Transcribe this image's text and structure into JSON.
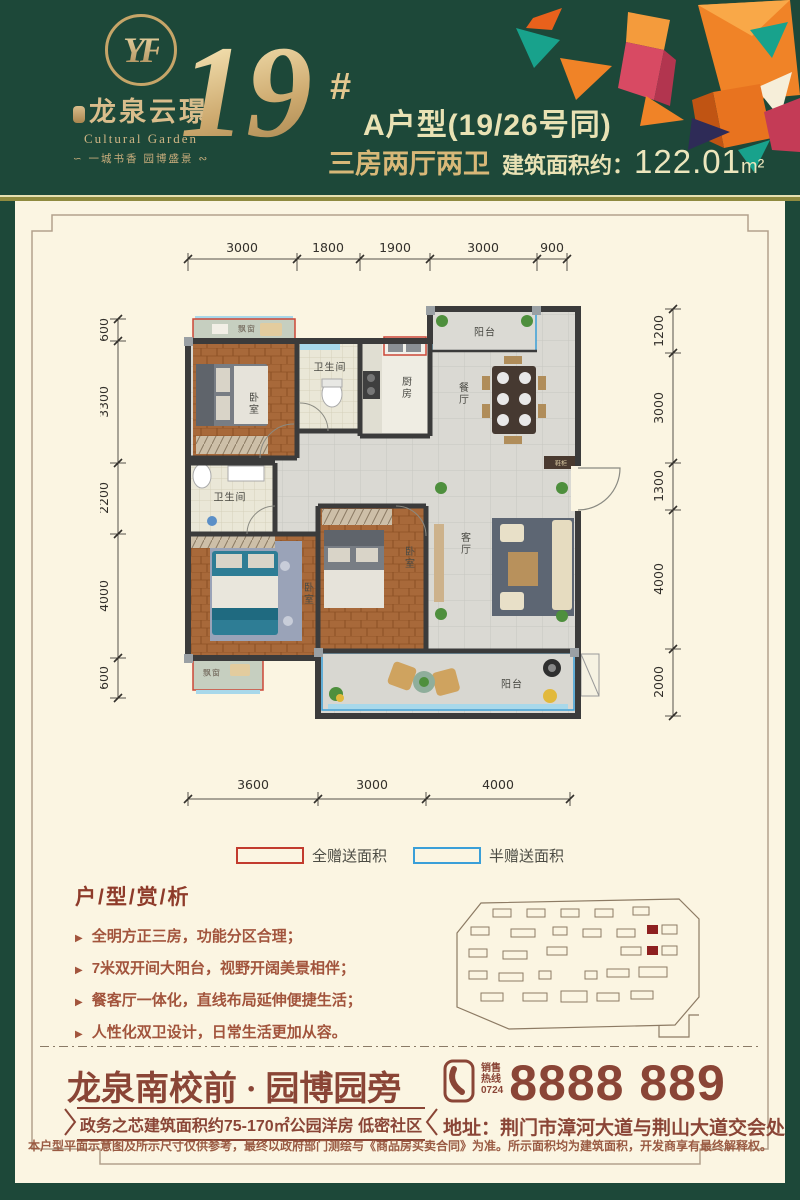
{
  "colors": {
    "green": "#1d4839",
    "cream": "#fbf5e2",
    "brown": "#8a4536",
    "gold": "#d8b878",
    "legend_full": "#c23b2e",
    "legend_half": "#3a9fd8",
    "site_highlight": "#8e2020"
  },
  "header": {
    "logo": {
      "monogram": "YF",
      "brand": "龙泉云璟",
      "brand_en": "Cultural Garden",
      "tagline": "∽ 一城书香  园博盛景 ∾"
    },
    "building_no": "19",
    "hash": "#",
    "unit_title": "A户型(19/26号同)",
    "layout": "三房两厅两卫",
    "area_label": "建筑面积约：",
    "area_value": "122.01",
    "area_unit": "m²"
  },
  "floorplan": {
    "dims_top": [
      "3000",
      "1800",
      "1900",
      "3000",
      "900"
    ],
    "dims_bottom": [
      "3600",
      "3000",
      "4000"
    ],
    "dims_left": [
      "600",
      "3300",
      "2200",
      "4000",
      "600"
    ],
    "dims_right": [
      "1200",
      "3000",
      "1300",
      "4000",
      "2000"
    ],
    "rooms": {
      "bedroom1": "卧室",
      "bath1": "卫生间",
      "kitchen": "厨房",
      "dining": "餐厅",
      "balcony_top": "阳台",
      "bath2": "卫生间",
      "bedroom2": "卧室",
      "bedroom3": "卧室",
      "living": "客厅",
      "balcony_bottom": "阳台",
      "bay1": "飘窗",
      "bay2": "飘窗",
      "shoe_cabinet": "鞋柜"
    }
  },
  "legend": {
    "full_gift": "全赠送面积",
    "half_gift": "半赠送面积"
  },
  "analysis": {
    "title": "户/型/赏/析",
    "bullets": [
      "全明方正三房，功能分区合理；",
      "7米双开间大阳台，视野开阔美景相伴；",
      "餐客厅一体化，直线布局延伸便捷生活；",
      "人性化双卫设计，日常生活更加从容。"
    ]
  },
  "footer": {
    "slogan": "龙泉南校前 · 园博园旁",
    "ribbon": "政务之芯建筑面积约75-170㎡公园洋房 低密社区",
    "hotline_line1": "销售",
    "hotline_line2": "热线",
    "hotline_code": "0724",
    "phone": "8888 889",
    "address": "地址：荆门市漳河大道与荆山大道交会处",
    "disclaimer": "本户型平面示意图及所示尺寸仅供参考，最终以政府部门测绘与《商品房买卖合同》为准。所示面积均为建筑面积，开发商享有最终解释权。"
  }
}
